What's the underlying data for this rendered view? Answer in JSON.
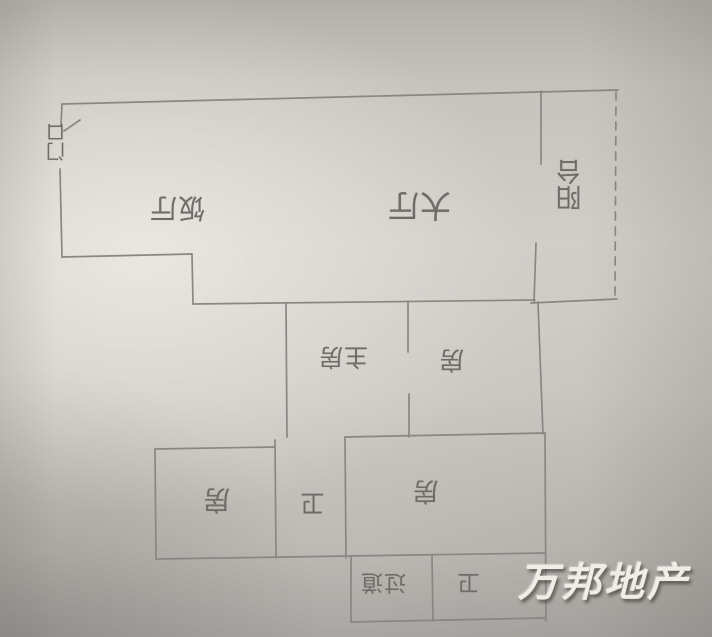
{
  "watermark": {
    "text": "万邦地产",
    "color": "#f0ede9"
  },
  "floor_plan": {
    "note_orientation": "labels drawn rotated 180° (photo upside-down)",
    "colors": {
      "pencil_line": "#8a8683",
      "handwriting": "#6f6b68",
      "paper": "#cdc9c4"
    },
    "rooms": {
      "entrance": {
        "label": "门口"
      },
      "dining": {
        "label": "饭厅"
      },
      "living": {
        "label": "大厅"
      },
      "balcony": {
        "label": "阳台"
      },
      "master": {
        "label": "主房"
      },
      "room_mid": {
        "label": "房"
      },
      "room_left": {
        "label": "房"
      },
      "bath_mid": {
        "label": "卫"
      },
      "room_right": {
        "label": "房"
      },
      "corridor": {
        "label": "过道"
      },
      "bath_bottom": {
        "label": "卫"
      }
    }
  }
}
